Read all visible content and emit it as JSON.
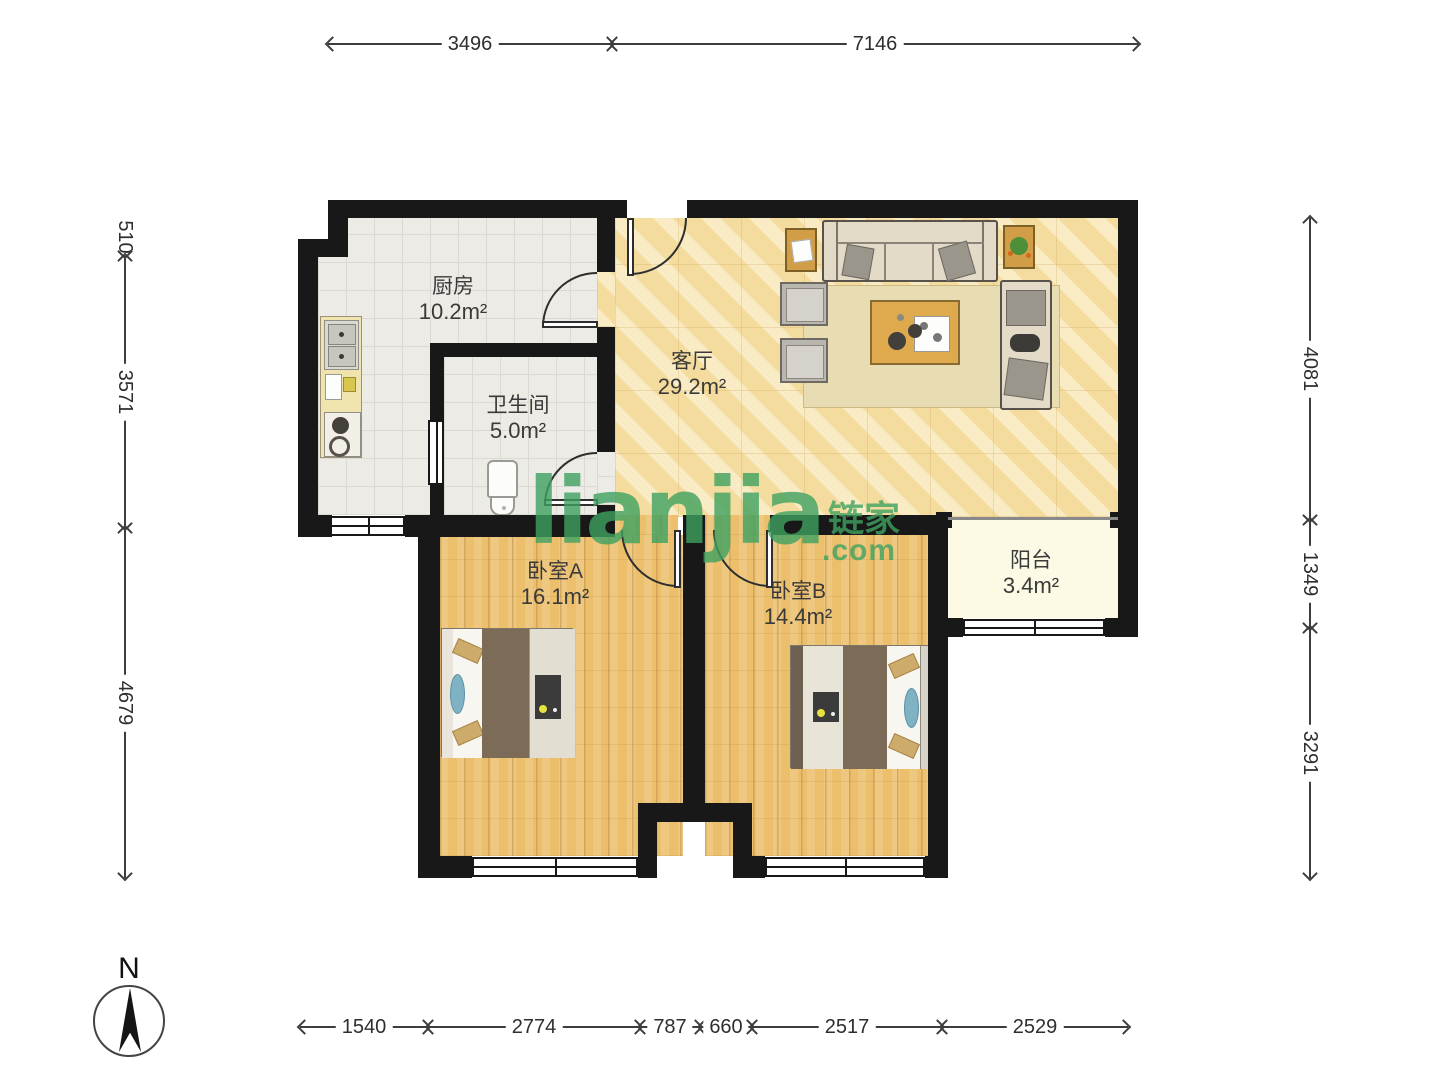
{
  "plan_title": "两室一厅户型图",
  "rooms": {
    "kitchen": {
      "name": "厨房",
      "area": "10.2m²"
    },
    "bathroom": {
      "name": "卫生间",
      "area": "5.0m²"
    },
    "living": {
      "name": "客厅",
      "area": "29.2m²"
    },
    "bedroom_a": {
      "name": "卧室A",
      "area": "16.1m²"
    },
    "bedroom_b": {
      "name": "卧室B",
      "area": "14.4m²"
    },
    "balcony": {
      "name": "阳台",
      "area": "3.4m²"
    }
  },
  "dimensions_mm": {
    "top": [
      "3496",
      "7146"
    ],
    "bottom": [
      "1540",
      "2774",
      "787",
      "660",
      "2517",
      "2529"
    ],
    "left": [
      "510",
      "3571",
      "4679"
    ],
    "right": [
      "4081",
      "1349",
      "3291"
    ]
  },
  "compass": {
    "label": "N"
  },
  "watermark": {
    "logo": "lianjia",
    "suffix": ".com",
    "cn": "链家"
  },
  "colors": {
    "wall": "#181818",
    "watermark_green": "#3fa261",
    "living_floor": "#f7e3ab",
    "bedroom_floor": "#ecbf6d",
    "tile_floor": "#edebe6",
    "balcony_floor": "#fcf9e4"
  }
}
